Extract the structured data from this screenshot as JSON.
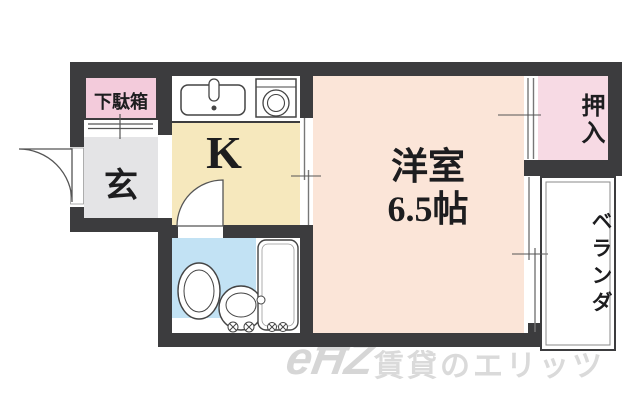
{
  "floorplan": {
    "entrance": {
      "shoe_cabinet_label": "下駄箱",
      "genkan_label": "玄"
    },
    "kitchen": {
      "label": "K"
    },
    "western_room": {
      "name": "洋室",
      "size": "6.5帖"
    },
    "closet": {
      "label": "押入"
    },
    "veranda": {
      "label": "ベランダ"
    },
    "fixtures": [
      "entrance-door-swing",
      "kitchen-sink",
      "gas-stove",
      "bathroom-door-swing",
      "toilet",
      "wash-basin",
      "bathtub",
      "sliding-door",
      "closet-sliding-door",
      "veranda-window"
    ],
    "colors": {
      "wall": "#3c3c3e",
      "kitchen_yellow": "#f6e8bd",
      "western_room_peach": "#fbe5d8",
      "closet_pink": "#f7dae4",
      "shoe_cabinet_pink": "#f3cbdb",
      "genkan_gray": "#e4e4e6",
      "bathroom_blue": "#c2e2f4"
    }
  },
  "watermark": {
    "logo": "eĦZ",
    "text": "賃貸のエリッツ"
  }
}
